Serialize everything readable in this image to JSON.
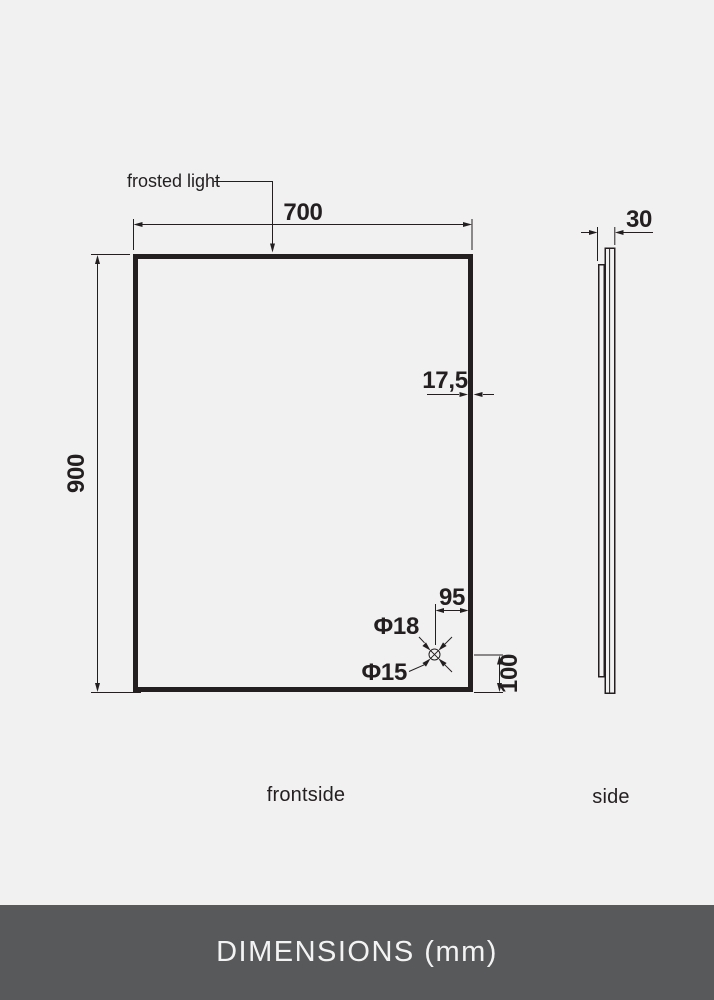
{
  "colors": {
    "background": "#f1f1f2",
    "line": "#231f20",
    "footer_bg": "#58595b",
    "footer_text": "#f3f3f4"
  },
  "front_view": {
    "label": "frontside",
    "annotation_label": "frosted light",
    "width_mm": "700",
    "height_mm": "900",
    "frame_mm": "17,5",
    "hole_offset_x_mm": "95",
    "hole_offset_y_mm": "100",
    "hole_outer_diameter": "Φ18",
    "hole_inner_diameter": "Φ15"
  },
  "side_view": {
    "label": "side",
    "depth_mm": "30"
  },
  "footer": {
    "title": "DIMENSIONS (mm)"
  }
}
